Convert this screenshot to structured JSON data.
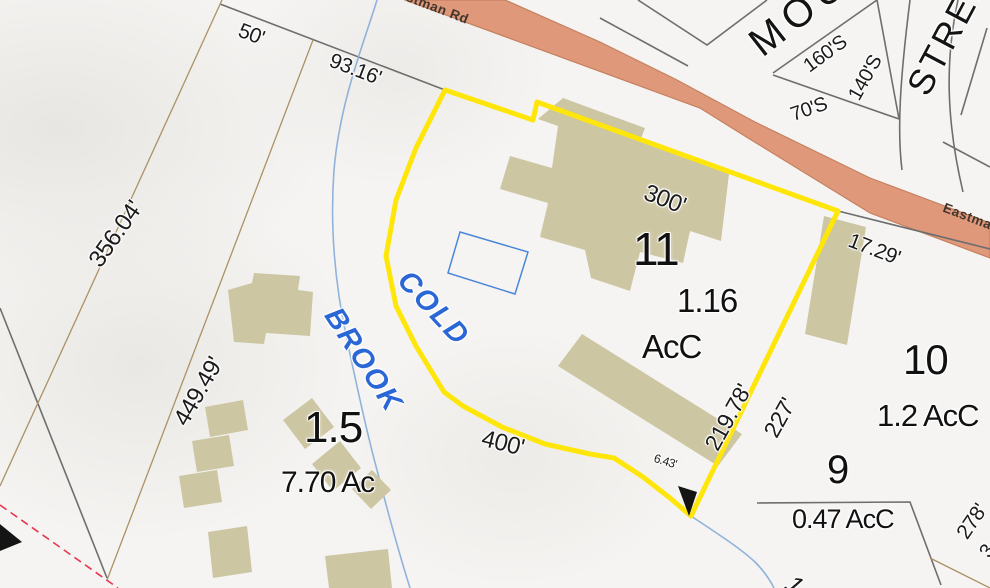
{
  "labels": {
    "road_label_top": "Eastman Rd",
    "road_label_right": "Eastman Rd",
    "street_mountain": "MOUNTAIN",
    "street_street": "STREET",
    "brook_cold": "COLD",
    "brook_brook": "BROOK",
    "dim_50": "50'",
    "dim_93_16": "93.16'",
    "dim_356_04": "356.04'",
    "dim_449_49": "449.49'",
    "dim_300": "300'",
    "dim_17_29": "17.29'",
    "dim_219_78": "219.78'",
    "dim_227": "227'",
    "dim_400": "400'",
    "dim_6_43": "6.43'",
    "dim_278": "278'",
    "dim_70s": "70'S",
    "dim_160s": "160'S",
    "dim_140s": "140'S",
    "partial_3": "3",
    "partial_1": "1"
  },
  "parcels": {
    "p11": {
      "id": "11",
      "area": "1.16",
      "unit": "AcC",
      "selected": true
    },
    "p10": {
      "id": "10",
      "area": "1.2 AcC"
    },
    "p9": {
      "id": "9",
      "area": "0.47 AcC"
    },
    "p1_5": {
      "id": "1.5",
      "area": "7.70 Ac"
    }
  },
  "colors": {
    "selected_parcel_outline": "#ffe60a",
    "road_fill": "#e0987a",
    "road_edge": "#c5805f",
    "building_fill": "#cdc6a3",
    "water_line": "#8fb3da",
    "water_label": "#2b66d6",
    "boundary_gray": "#6e6e6e",
    "boundary_tan": "#ab9264",
    "survey_dashed_red": "#e83550",
    "background": "#f5f4f2"
  }
}
